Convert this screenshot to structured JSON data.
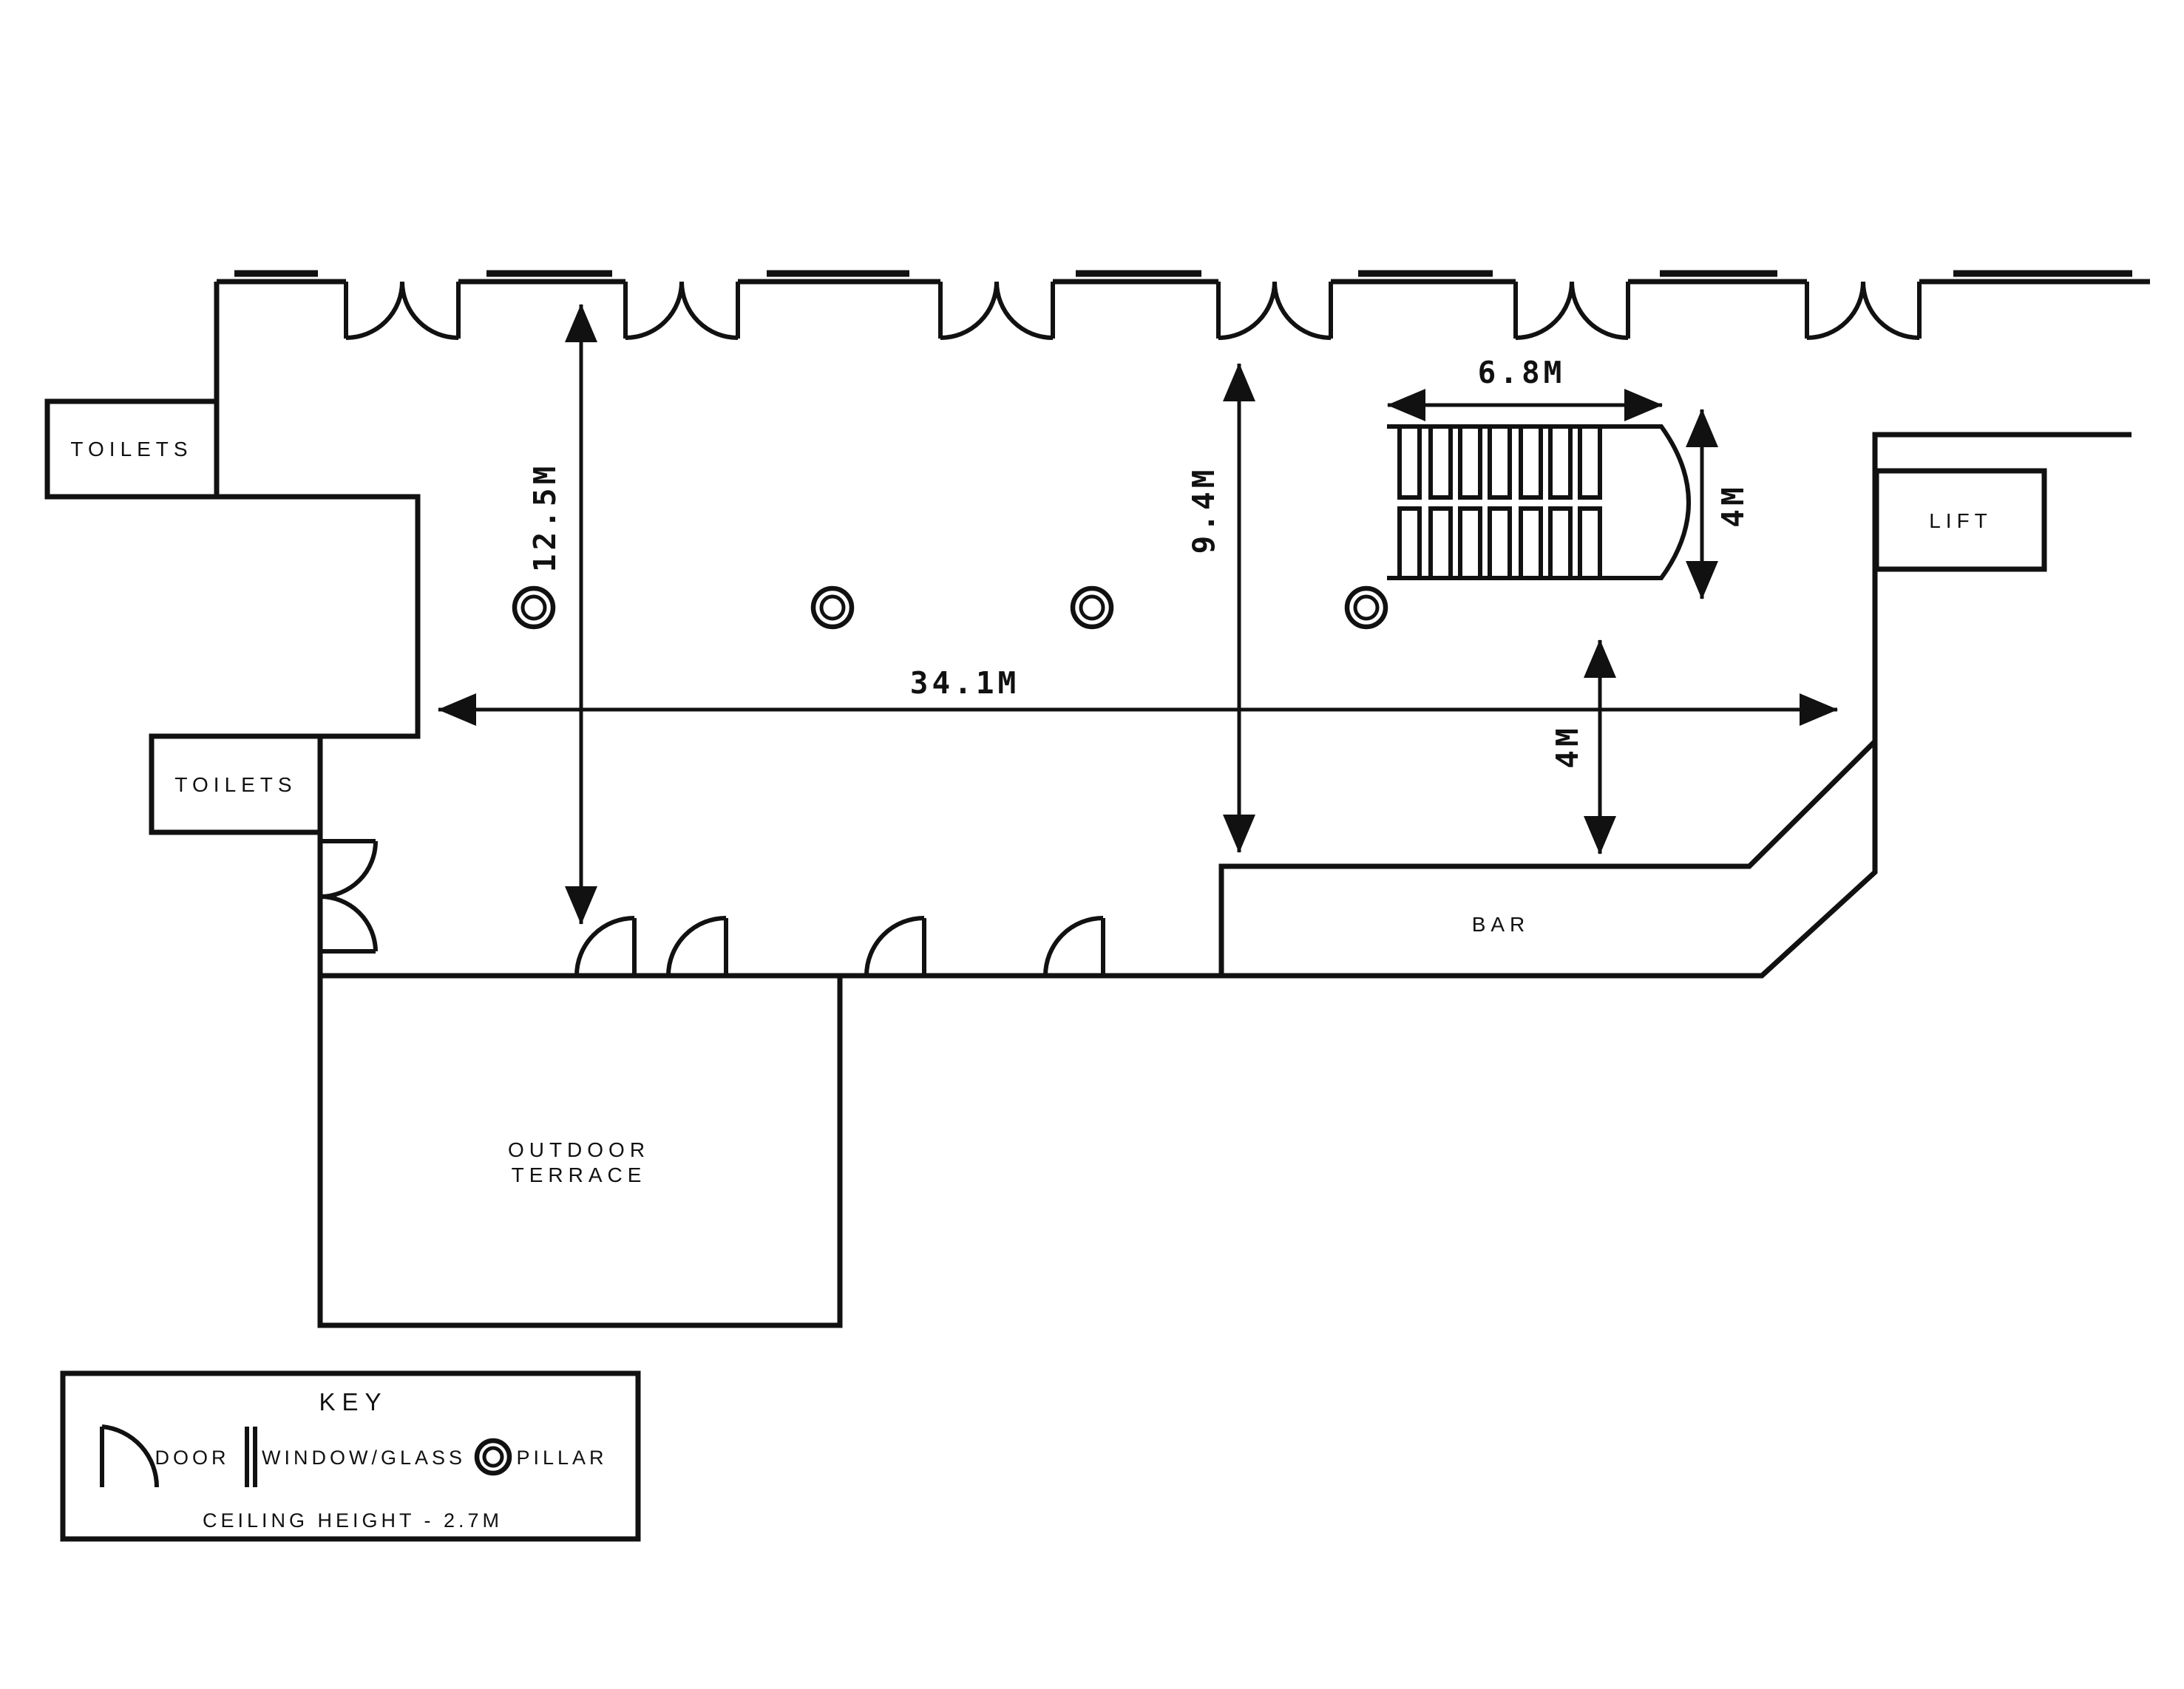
{
  "colors": {
    "ink": "#111111",
    "background": "#ffffff"
  },
  "labels": {
    "toilets_upper": "TOILETS",
    "toilets_lower": "TOILETS",
    "lift": "LIFT",
    "bar": "BAR",
    "terrace_line1": "OUTDOOR",
    "terrace_line2": "TERRACE"
  },
  "dimensions": {
    "hall_height": "12.5M",
    "hall_depth": "9.4M",
    "hall_length": "34.1M",
    "stairs_length": "6.8M",
    "stairs_width": "4M",
    "bar_gap": "4M"
  },
  "legend": {
    "title": "KEY",
    "door_label": "DOOR",
    "window_label": "WINDOW/GLASS",
    "pillar_label": "PILLAR",
    "ceiling_note": "CEILING HEIGHT - 2.7M"
  }
}
